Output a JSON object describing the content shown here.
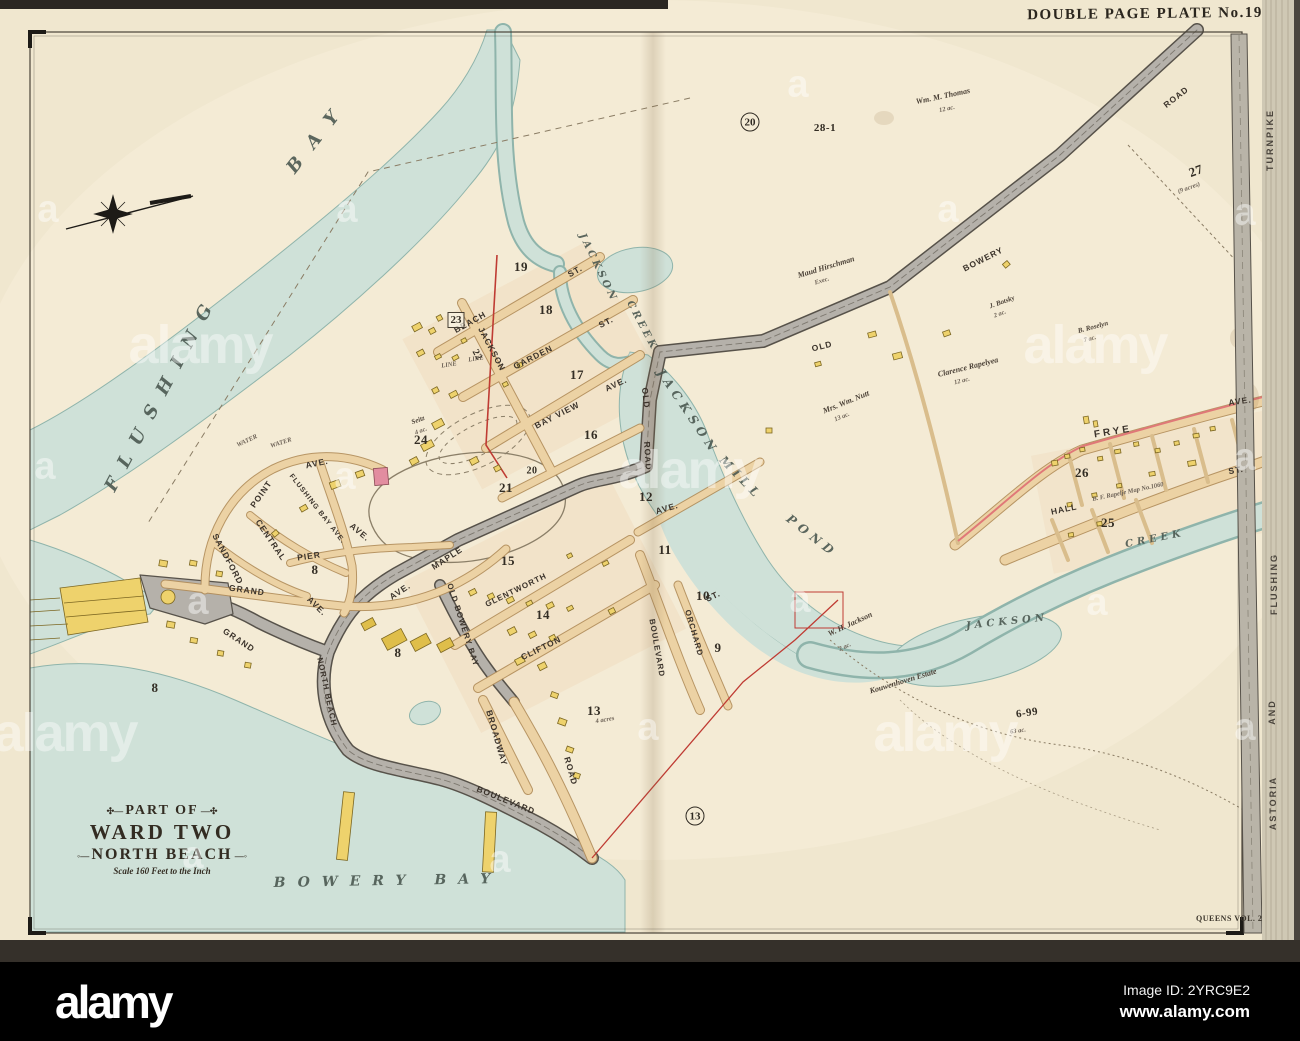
{
  "colors": {
    "paper": "#f0e7cf",
    "paperHi": "#f7efdb",
    "water": "#cfe1d8",
    "waterEdge": "#8fb4ab",
    "roadTan": "#ecd2a4",
    "roadTanEdge": "#b18c58",
    "roadGray": "#b5b1aa",
    "roadGrayEdge": "#57524a",
    "bldg": "#eed26c",
    "bldgEdge": "#7c6722",
    "bldgDark": "#dfbe4a",
    "pink": "#e28da0",
    "red": "#bf3b33",
    "ink": "#2f2a22"
  },
  "plate": {
    "header": "DOUBLE PAGE PLATE No.19",
    "volume": "QUEENS VOL. 2",
    "cartouche": {
      "line1": "PART OF",
      "line2": "WARD TWO",
      "line3": "NORTH BEACH",
      "scale": "Scale 160 Feet to the Inch"
    }
  },
  "alamy_bar": {
    "logo": "alamy",
    "image_id": "Image ID: 2YRC9E2",
    "url": "www.alamy.com"
  },
  "watermark": {
    "logo_text": "alamy",
    "mark_text": "a",
    "big": [
      [
        200,
        345
      ],
      [
        690,
        470
      ],
      [
        1095,
        345
      ],
      [
        945,
        733
      ],
      [
        65,
        733
      ]
    ],
    "small": [
      [
        798,
        85
      ],
      [
        48,
        210
      ],
      [
        347,
        210
      ],
      [
        948,
        210
      ],
      [
        1245,
        213
      ],
      [
        45,
        467
      ],
      [
        345,
        477
      ],
      [
        1245,
        458
      ],
      [
        198,
        602
      ],
      [
        800,
        600
      ],
      [
        1097,
        603
      ],
      [
        648,
        728
      ],
      [
        1245,
        728
      ],
      [
        500,
        860
      ],
      [
        193,
        856
      ]
    ]
  },
  "map": {
    "labels": [
      {
        "t": "FLUSHING",
        "x": 162,
        "y": 392,
        "r": -62,
        "c": "w",
        "fs": 18,
        "ls": 14,
        "nm": "water-label-flushing"
      },
      {
        "t": "BAY",
        "x": 318,
        "y": 136,
        "r": -52,
        "c": "w",
        "fs": 18,
        "ls": 16,
        "nm": "water-label-bay"
      },
      {
        "t": "BOWERY BAY",
        "x": 388,
        "y": 881,
        "r": -1,
        "c": "w",
        "fs": 14,
        "ls": 12,
        "nm": "water-label-bowery-bay"
      },
      {
        "t": "JACKSON",
        "x": 598,
        "y": 268,
        "r": 64,
        "c": "w",
        "fs": 10,
        "ls": 3
      },
      {
        "t": "CREEK",
        "x": 642,
        "y": 326,
        "r": 62,
        "c": "w",
        "fs": 10,
        "ls": 3
      },
      {
        "t": "JACKSON",
        "x": 688,
        "y": 412,
        "r": 56,
        "c": "w",
        "fs": 12,
        "ls": 5,
        "nm": "water-label-jackson-mill-pond"
      },
      {
        "t": "MILL",
        "x": 741,
        "y": 478,
        "r": 46,
        "c": "w",
        "fs": 12,
        "ls": 5
      },
      {
        "t": "POND",
        "x": 812,
        "y": 536,
        "r": 38,
        "c": "w",
        "fs": 12,
        "ls": 5
      },
      {
        "t": "JACKSON",
        "x": 1007,
        "y": 622,
        "r": -6,
        "c": "w",
        "fs": 10,
        "ls": 4
      },
      {
        "t": "CREEK",
        "x": 1155,
        "y": 539,
        "r": -11,
        "c": "w",
        "fs": 10,
        "ls": 4
      },
      {
        "t": "BEACH",
        "x": 470,
        "y": 322,
        "r": -29,
        "c": "s",
        "nm": "street-beach-st"
      },
      {
        "t": "ST.",
        "x": 575,
        "y": 271,
        "r": -29,
        "c": "s"
      },
      {
        "t": "GARDEN",
        "x": 533,
        "y": 357,
        "r": -27,
        "c": "s",
        "nm": "street-garden-st"
      },
      {
        "t": "ST.",
        "x": 606,
        "y": 322,
        "r": -27,
        "c": "s"
      },
      {
        "t": "BAY VIEW",
        "x": 557,
        "y": 415,
        "r": -27,
        "c": "s",
        "nm": "street-bay-view-ave"
      },
      {
        "t": "AVE.",
        "x": 616,
        "y": 384,
        "r": -25,
        "c": "s"
      },
      {
        "t": "JACKSON",
        "x": 492,
        "y": 349,
        "r": 62,
        "c": "s",
        "nm": "street-jackson"
      },
      {
        "t": "OLD",
        "x": 822,
        "y": 346,
        "r": -14,
        "c": "s",
        "nm": "street-old-bowery-road"
      },
      {
        "t": "BOWERY",
        "x": 983,
        "y": 259,
        "r": -27,
        "c": "s"
      },
      {
        "t": "ROAD",
        "x": 1176,
        "y": 97,
        "r": -38,
        "c": "s"
      },
      {
        "t": "OLD",
        "x": 646,
        "y": 398,
        "r": 84,
        "c": "s"
      },
      {
        "t": "ROAD",
        "x": 648,
        "y": 456,
        "r": 86,
        "c": "s"
      },
      {
        "t": "OLD BOWERY BAY",
        "x": 463,
        "y": 625,
        "r": 72,
        "c": "s",
        "fs": 8,
        "nm": "street-old-bowery-bay"
      },
      {
        "t": "MAPLE",
        "x": 447,
        "y": 558,
        "r": -33,
        "c": "s",
        "nm": "street-maple-ave"
      },
      {
        "t": "AVE.",
        "x": 400,
        "y": 591,
        "r": -33,
        "c": "s"
      },
      {
        "t": "GLENTWORTH",
        "x": 516,
        "y": 590,
        "r": -26,
        "c": "s",
        "fs": 8,
        "nm": "street-glentworth"
      },
      {
        "t": "CLIFTON",
        "x": 541,
        "y": 648,
        "r": -26,
        "c": "s",
        "nm": "street-clifton"
      },
      {
        "t": "BROADWAY",
        "x": 497,
        "y": 738,
        "r": 74,
        "c": "s",
        "nm": "street-broadway"
      },
      {
        "t": "ROAD",
        "x": 571,
        "y": 771,
        "r": 74,
        "c": "s"
      },
      {
        "t": "BOULEVARD",
        "x": 506,
        "y": 800,
        "r": 22,
        "c": "s",
        "nm": "street-boulevard-shore"
      },
      {
        "t": "BOULEVARD",
        "x": 657,
        "y": 648,
        "r": 80,
        "c": "s",
        "fs": 8,
        "nm": "street-boulevard"
      },
      {
        "t": "ORCHARD",
        "x": 694,
        "y": 633,
        "r": 74,
        "c": "s",
        "fs": 8,
        "nm": "street-orchard-st"
      },
      {
        "t": "ST.",
        "x": 713,
        "y": 596,
        "r": -25,
        "c": "s"
      },
      {
        "t": "NORTH BEACH",
        "x": 327,
        "y": 692,
        "r": 78,
        "c": "s",
        "fs": 8,
        "nm": "street-north-beach"
      },
      {
        "t": "GRAND",
        "x": 247,
        "y": 590,
        "r": 8,
        "c": "s",
        "nm": "street-grand-ave"
      },
      {
        "t": "GRAND",
        "x": 239,
        "y": 640,
        "r": 33,
        "c": "s"
      },
      {
        "t": "AVE.",
        "x": 317,
        "y": 606,
        "r": 44,
        "c": "s"
      },
      {
        "t": "AVE.",
        "x": 317,
        "y": 463,
        "r": -12,
        "c": "s"
      },
      {
        "t": "POINT",
        "x": 261,
        "y": 494,
        "r": -55,
        "c": "s",
        "nm": "street-point-ave"
      },
      {
        "t": "FLUSHING BAY AVE.",
        "x": 317,
        "y": 509,
        "r": 52,
        "c": "s",
        "fs": 7,
        "nm": "street-flushing-bay-ave"
      },
      {
        "t": "CENTRAL",
        "x": 271,
        "y": 540,
        "r": 56,
        "c": "s",
        "nm": "street-central"
      },
      {
        "t": "SANDFORD",
        "x": 228,
        "y": 559,
        "r": 62,
        "c": "s",
        "nm": "street-sandford"
      },
      {
        "t": "PIER",
        "x": 309,
        "y": 556,
        "r": -8,
        "c": "s",
        "nm": "street-pier-ave"
      },
      {
        "t": "AVE.",
        "x": 360,
        "y": 532,
        "r": 40,
        "c": "s"
      },
      {
        "t": "FRYE",
        "x": 1113,
        "y": 432,
        "r": -9,
        "c": "s",
        "fs": 10,
        "ls": 3,
        "nm": "street-frye-ave"
      },
      {
        "t": "AVE.",
        "x": 1240,
        "y": 401,
        "r": -8,
        "c": "s"
      },
      {
        "t": "HALL",
        "x": 1064,
        "y": 509,
        "r": -12,
        "c": "s",
        "nm": "street-hall-st"
      },
      {
        "t": "ST.",
        "x": 1236,
        "y": 470,
        "r": -10,
        "c": "s"
      },
      {
        "t": "AVE.",
        "x": 667,
        "y": 508,
        "r": -16,
        "c": "s"
      },
      {
        "t": "TURNPIKE",
        "x": 1270,
        "y": 140,
        "r": -90,
        "c": "m",
        "nm": "margin-turnpike"
      },
      {
        "t": "FLUSHING",
        "x": 1274,
        "y": 584,
        "r": -90,
        "c": "m",
        "nm": "margin-flushing"
      },
      {
        "t": "AND",
        "x": 1272,
        "y": 712,
        "r": -90,
        "c": "m"
      },
      {
        "t": "ASTORIA",
        "x": 1273,
        "y": 803,
        "r": -90,
        "c": "m",
        "nm": "margin-astoria"
      },
      {
        "t": "19",
        "x": 521,
        "y": 267,
        "c": "b",
        "nm": "block-19"
      },
      {
        "t": "18",
        "x": 546,
        "y": 310,
        "c": "b",
        "nm": "block-18"
      },
      {
        "t": "17",
        "x": 577,
        "y": 375,
        "c": "b",
        "nm": "block-17"
      },
      {
        "t": "16",
        "x": 591,
        "y": 435,
        "c": "b",
        "nm": "block-16"
      },
      {
        "t": "23",
        "x": 456,
        "y": 320,
        "c": "bb",
        "nm": "block-23"
      },
      {
        "t": "22",
        "x": 477,
        "y": 355,
        "r": 62,
        "c": "b",
        "fs": 10,
        "nm": "block-22"
      },
      {
        "t": "21",
        "x": 506,
        "y": 488,
        "c": "b",
        "nm": "block-21"
      },
      {
        "t": "24",
        "x": 421,
        "y": 440,
        "c": "b",
        "nm": "block-24"
      },
      {
        "t": "20",
        "x": 532,
        "y": 471,
        "c": "b",
        "fs": 10,
        "nm": "block-20"
      },
      {
        "t": "15",
        "x": 508,
        "y": 561,
        "c": "b",
        "nm": "block-15"
      },
      {
        "t": "14",
        "x": 543,
        "y": 615,
        "c": "b",
        "nm": "block-14"
      },
      {
        "t": "12",
        "x": 646,
        "y": 497,
        "c": "b",
        "nm": "block-12"
      },
      {
        "t": "11",
        "x": 665,
        "y": 550,
        "c": "b",
        "nm": "block-11"
      },
      {
        "t": "10",
        "x": 703,
        "y": 596,
        "c": "b",
        "nm": "block-10"
      },
      {
        "t": "9",
        "x": 718,
        "y": 648,
        "c": "b",
        "nm": "block-9"
      },
      {
        "t": "13",
        "x": 594,
        "y": 711,
        "c": "b",
        "nm": "block-13"
      },
      {
        "t": "8",
        "x": 315,
        "y": 570,
        "c": "b",
        "nm": "block-8a"
      },
      {
        "t": "8",
        "x": 398,
        "y": 653,
        "c": "b",
        "nm": "block-8b"
      },
      {
        "t": "8",
        "x": 155,
        "y": 688,
        "c": "b",
        "nm": "block-8c"
      },
      {
        "t": "25",
        "x": 1108,
        "y": 523,
        "c": "b",
        "nm": "block-25"
      },
      {
        "t": "26",
        "x": 1082,
        "y": 473,
        "c": "b",
        "nm": "block-26"
      },
      {
        "t": "27",
        "x": 1196,
        "y": 171,
        "r": -20,
        "c": "b",
        "nm": "block-27"
      },
      {
        "t": "28-1",
        "x": 825,
        "y": 128,
        "c": "b",
        "fs": 11,
        "nm": "block-28-1"
      },
      {
        "t": "6-99",
        "x": 1027,
        "y": 713,
        "r": -8,
        "c": "b",
        "fs": 11,
        "nm": "parcel-6-99"
      },
      {
        "t": "20",
        "x": 750,
        "y": 122,
        "c": "c",
        "nm": "circled-20"
      },
      {
        "t": "13",
        "x": 695,
        "y": 816,
        "c": "c",
        "nm": "circled-13"
      },
      {
        "t": "Wm. M. Thomas",
        "x": 943,
        "y": 96,
        "r": -12,
        "c": "e",
        "nm": "estate-wm-m-thomas"
      },
      {
        "t": "12 ac.",
        "x": 947,
        "y": 109,
        "r": -12,
        "c": "t"
      },
      {
        "t": "Maud Hirschman",
        "x": 826,
        "y": 267,
        "r": -17,
        "c": "e",
        "nm": "estate-maud-hirschman"
      },
      {
        "t": "Exec.",
        "x": 822,
        "y": 281,
        "r": -17,
        "c": "t"
      },
      {
        "t": "Mrs. Wm. Nutt",
        "x": 846,
        "y": 402,
        "r": -22,
        "c": "e",
        "nm": "estate-mrs-wm-nutt"
      },
      {
        "t": "13 ac.",
        "x": 842,
        "y": 417,
        "r": -22,
        "c": "t"
      },
      {
        "t": "Clarence Rapelyea",
        "x": 968,
        "y": 367,
        "r": -14,
        "c": "e",
        "nm": "estate-clarence-rapelyea"
      },
      {
        "t": "12 ac.",
        "x": 962,
        "y": 381,
        "r": -14,
        "c": "t"
      },
      {
        "t": "J. Botsky",
        "x": 1002,
        "y": 302,
        "r": -20,
        "c": "e",
        "fs": 7,
        "nm": "estate-j-botsky"
      },
      {
        "t": "2 ac.",
        "x": 1000,
        "y": 314,
        "r": -20,
        "c": "t"
      },
      {
        "t": "B. Roselyn",
        "x": 1093,
        "y": 327,
        "r": -15,
        "c": "e",
        "fs": 7,
        "nm": "estate-b-roselyn"
      },
      {
        "t": "7 ac.",
        "x": 1090,
        "y": 339,
        "r": -15,
        "c": "t"
      },
      {
        "t": "W. H. Jackson",
        "x": 850,
        "y": 624,
        "r": -25,
        "c": "e",
        "nm": "estate-w-h-jackson"
      },
      {
        "t": "2 ac.",
        "x": 845,
        "y": 647,
        "r": -25,
        "c": "t"
      },
      {
        "t": "Kouwenhoven Estate",
        "x": 903,
        "y": 681,
        "r": -17,
        "c": "e",
        "nm": "estate-kouwenhoven"
      },
      {
        "t": "Seitz",
        "x": 418,
        "y": 420,
        "r": -20,
        "c": "e",
        "fs": 7,
        "nm": "estate-seitz"
      },
      {
        "t": "4 ac.",
        "x": 421,
        "y": 431,
        "r": -20,
        "c": "t"
      },
      {
        "t": "B. F. Rapelje Map No.1060",
        "x": 1128,
        "y": 492,
        "r": -12,
        "c": "t",
        "nm": "note-rapelje-map"
      },
      {
        "t": "4 acres",
        "x": 605,
        "y": 720,
        "r": -10,
        "c": "t"
      },
      {
        "t": "(9 acres)",
        "x": 1189,
        "y": 188,
        "r": -20,
        "c": "t"
      },
      {
        "t": "63 ac.",
        "x": 1018,
        "y": 731,
        "r": -8,
        "c": "t"
      },
      {
        "t": "WATER",
        "x": 247,
        "y": 441,
        "r": -25,
        "c": "t"
      },
      {
        "t": "WATER",
        "x": 281,
        "y": 443,
        "r": -18,
        "c": "t"
      },
      {
        "t": "LINE",
        "x": 449,
        "y": 365,
        "r": -8,
        "c": "t"
      },
      {
        "t": "LINE",
        "x": 476,
        "y": 359,
        "r": -8,
        "c": "t"
      }
    ]
  }
}
